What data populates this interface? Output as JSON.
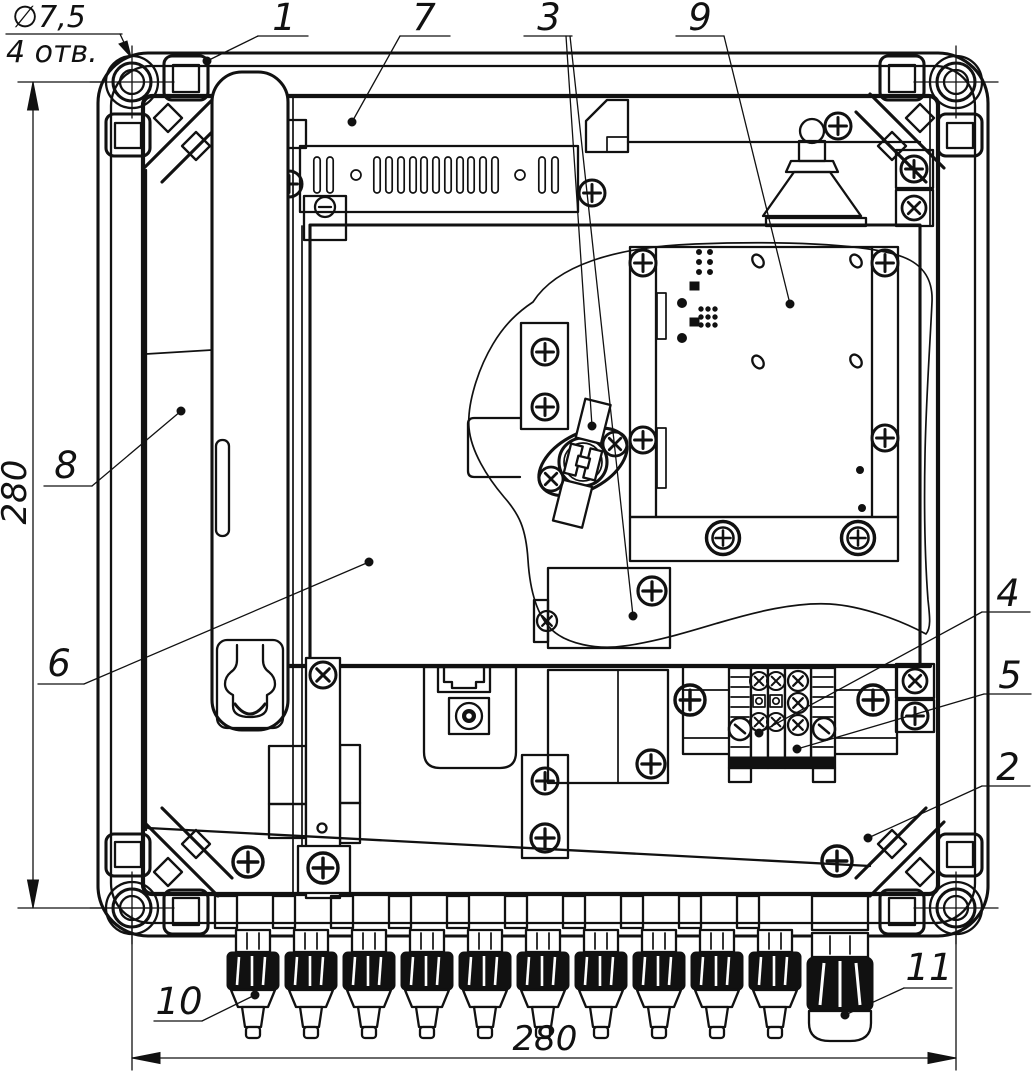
{
  "drawing": {
    "callouts": [
      "1",
      "7",
      "3",
      "9",
      "8",
      "6",
      "4",
      "5",
      "2",
      "10",
      "11"
    ],
    "dimensions": {
      "width": "280",
      "height": "280"
    },
    "hole_note": {
      "diameter": "∅7,5",
      "count": "4 отв."
    },
    "colors": {
      "line": "#111111",
      "background": "#ffffff"
    }
  }
}
